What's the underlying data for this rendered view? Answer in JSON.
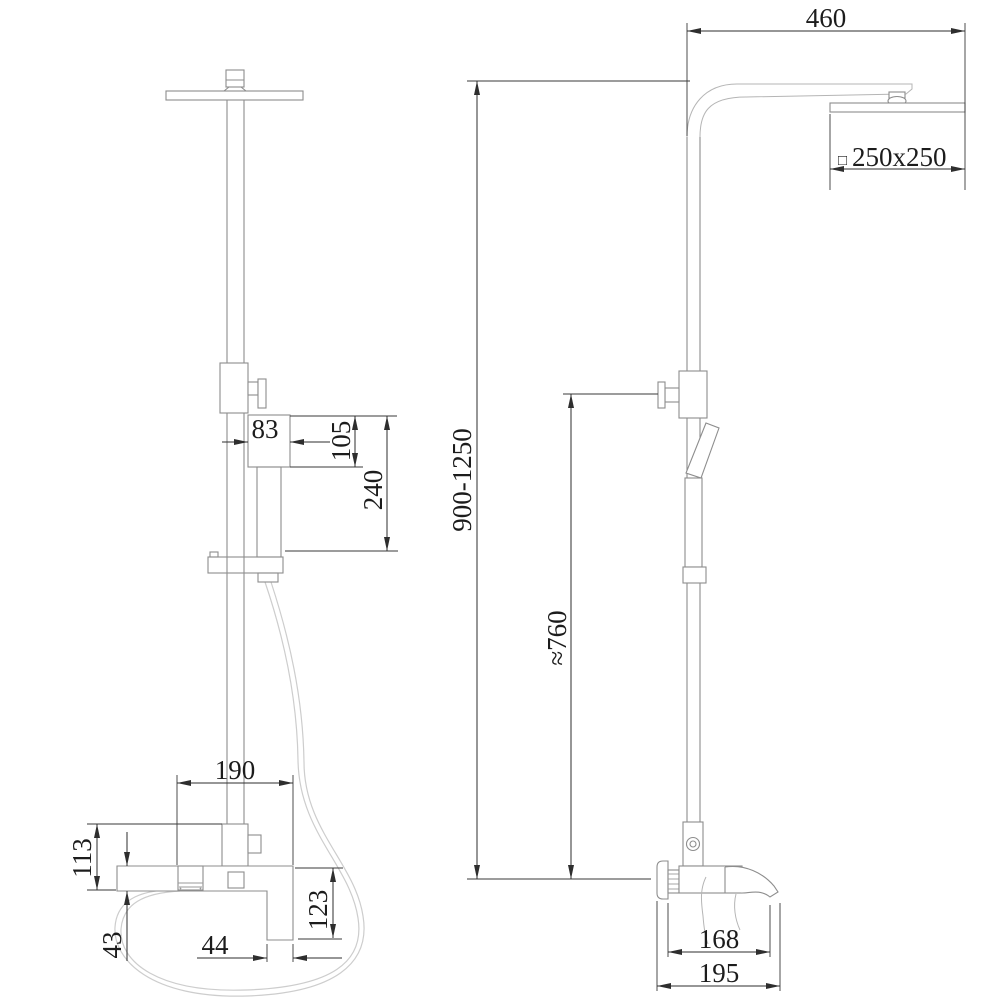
{
  "drawing": {
    "type": "shower-system-technical-drawing",
    "dimensions": {
      "arm_reach": "460",
      "head_size_symbol": "□",
      "head_size": "250x250",
      "total_height": "900-1250",
      "hand_shower_height": "≈760",
      "handset_width": "83",
      "handset_head_height": "105",
      "handset_length": "240",
      "mixer_width": "190",
      "mixer_inlet_height": "113",
      "mixer_body_height": "43",
      "spout_width": "44",
      "spout_drop": "123",
      "spout_reach": "168",
      "mixer_total_depth": "195"
    }
  }
}
